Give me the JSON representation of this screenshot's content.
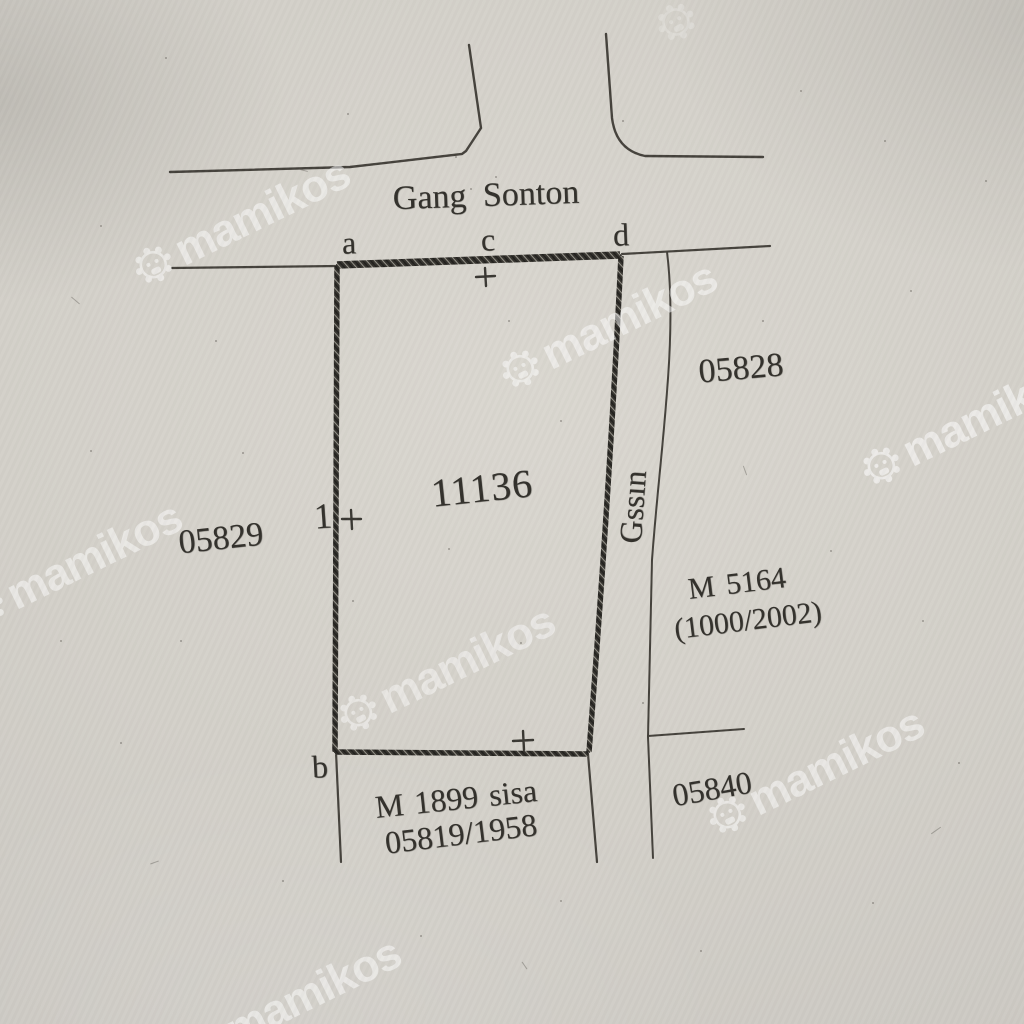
{
  "street": {
    "name": "Gang Sonton"
  },
  "parcel": {
    "number": "11136",
    "point_label": "1",
    "corner_labels": {
      "a": "a",
      "b": "b",
      "c": "c",
      "d": "d"
    }
  },
  "neighbors": {
    "left": "05829",
    "right_top": "05828",
    "bottom_right": "05840"
  },
  "alley": {
    "name": "Gssın"
  },
  "references": {
    "right": {
      "line1": "M 5164",
      "line2": "(1000/2002)"
    },
    "bottom": {
      "line1": "M 1899 sisa",
      "line2": "05819/1958"
    }
  },
  "colors": {
    "paper": "#d3d0c9",
    "ink": "#3a3833",
    "watermark": "#ffffff"
  },
  "watermark": {
    "text": "mamikos",
    "rotation_deg": -26,
    "instances": [
      {
        "x": 152,
        "y": 262,
        "o": 0.5
      },
      {
        "x": 519,
        "y": 366,
        "o": 0.5
      },
      {
        "x": 880,
        "y": 463,
        "o": 0.55
      },
      {
        "x": -16,
        "y": 606,
        "o": 0.5
      },
      {
        "x": 357,
        "y": 710,
        "o": 0.45
      },
      {
        "x": 726,
        "y": 812,
        "o": 0.5
      },
      {
        "x": 203,
        "y": 1042,
        "o": 0.5
      },
      {
        "x": 676,
        "y": 22,
        "o": 0.22,
        "logo_only": true
      }
    ]
  },
  "specks": [
    [
      455,
      156,
      2
    ],
    [
      470,
      188,
      2
    ],
    [
      495,
      176,
      2
    ],
    [
      347,
      113,
      2
    ],
    [
      165,
      57,
      2
    ],
    [
      100,
      225,
      2
    ],
    [
      622,
      120,
      2
    ],
    [
      90,
      450,
      2
    ],
    [
      215,
      340,
      2
    ],
    [
      560,
      420,
      2
    ],
    [
      762,
      320,
      2
    ],
    [
      830,
      550,
      2
    ],
    [
      922,
      620,
      2
    ],
    [
      352,
      600,
      2
    ],
    [
      282,
      880,
      2
    ],
    [
      560,
      900,
      2
    ],
    [
      700,
      950,
      2
    ],
    [
      872,
      902,
      2
    ],
    [
      958,
      762,
      2
    ],
    [
      420,
      935,
      2
    ],
    [
      120,
      742,
      2
    ],
    [
      60,
      640,
      2
    ],
    [
      985,
      180,
      2
    ],
    [
      800,
      90,
      2
    ],
    [
      910,
      290,
      2
    ],
    [
      180,
      640,
      2
    ],
    [
      242,
      452,
      2
    ],
    [
      520,
      642,
      2
    ],
    [
      642,
      702,
      2
    ],
    [
      884,
      140,
      2
    ],
    [
      448,
      548,
      2
    ],
    [
      508,
      320,
      2
    ]
  ],
  "fibers": [
    [
      70,
      300,
      11,
      40
    ],
    [
      150,
      862,
      9,
      -20
    ],
    [
      740,
      470,
      10,
      70
    ],
    [
      300,
      170,
      8,
      15
    ],
    [
      930,
      830,
      12,
      -35
    ],
    [
      520,
      965,
      9,
      55
    ]
  ]
}
